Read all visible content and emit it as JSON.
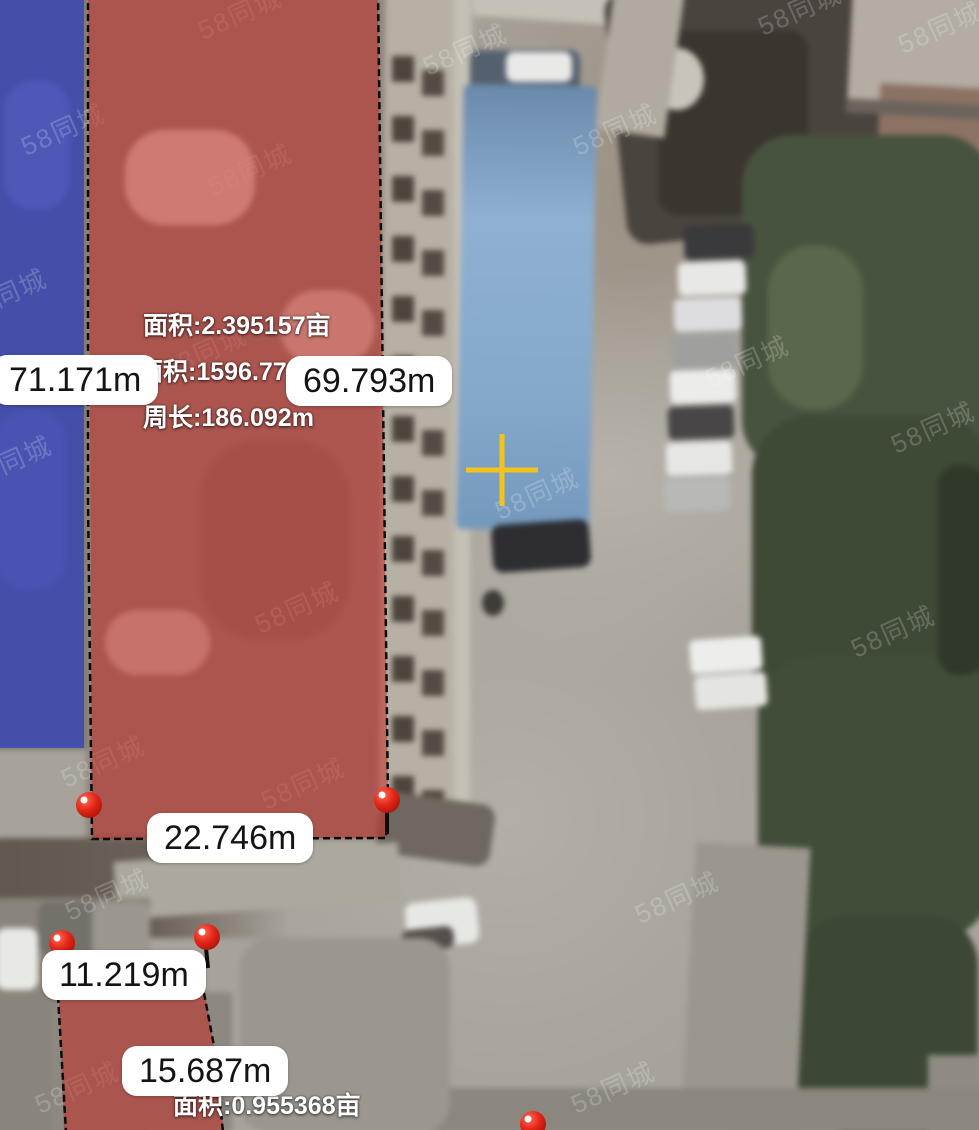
{
  "watermark": {
    "text": "58同城",
    "color": "#FFFFFF"
  },
  "center_marker": {
    "type": "crosshair",
    "color": "#F1C41D"
  },
  "markers": {
    "vertex_color": "#E3261A"
  },
  "regions": {
    "main": {
      "fill_color": "#C62822",
      "border_color": "#0B0B0B",
      "labels": {
        "area_mu": "面积:2.395157亩",
        "area_m2": "面积:1596.771m²",
        "perimeter": "周长:186.092m"
      },
      "edge_labels": {
        "left": "71.171m",
        "right": "69.793m",
        "bottom": "22.746m"
      }
    },
    "secondary": {
      "fill_color": "#C62822",
      "labels": {
        "area_mu": "面积:0.955368亩"
      },
      "edge_labels": {
        "segment_a": "11.219m",
        "segment_b": "15.687m"
      }
    },
    "adjacent_blue": {
      "fill_color": "#2C3EBE"
    }
  }
}
